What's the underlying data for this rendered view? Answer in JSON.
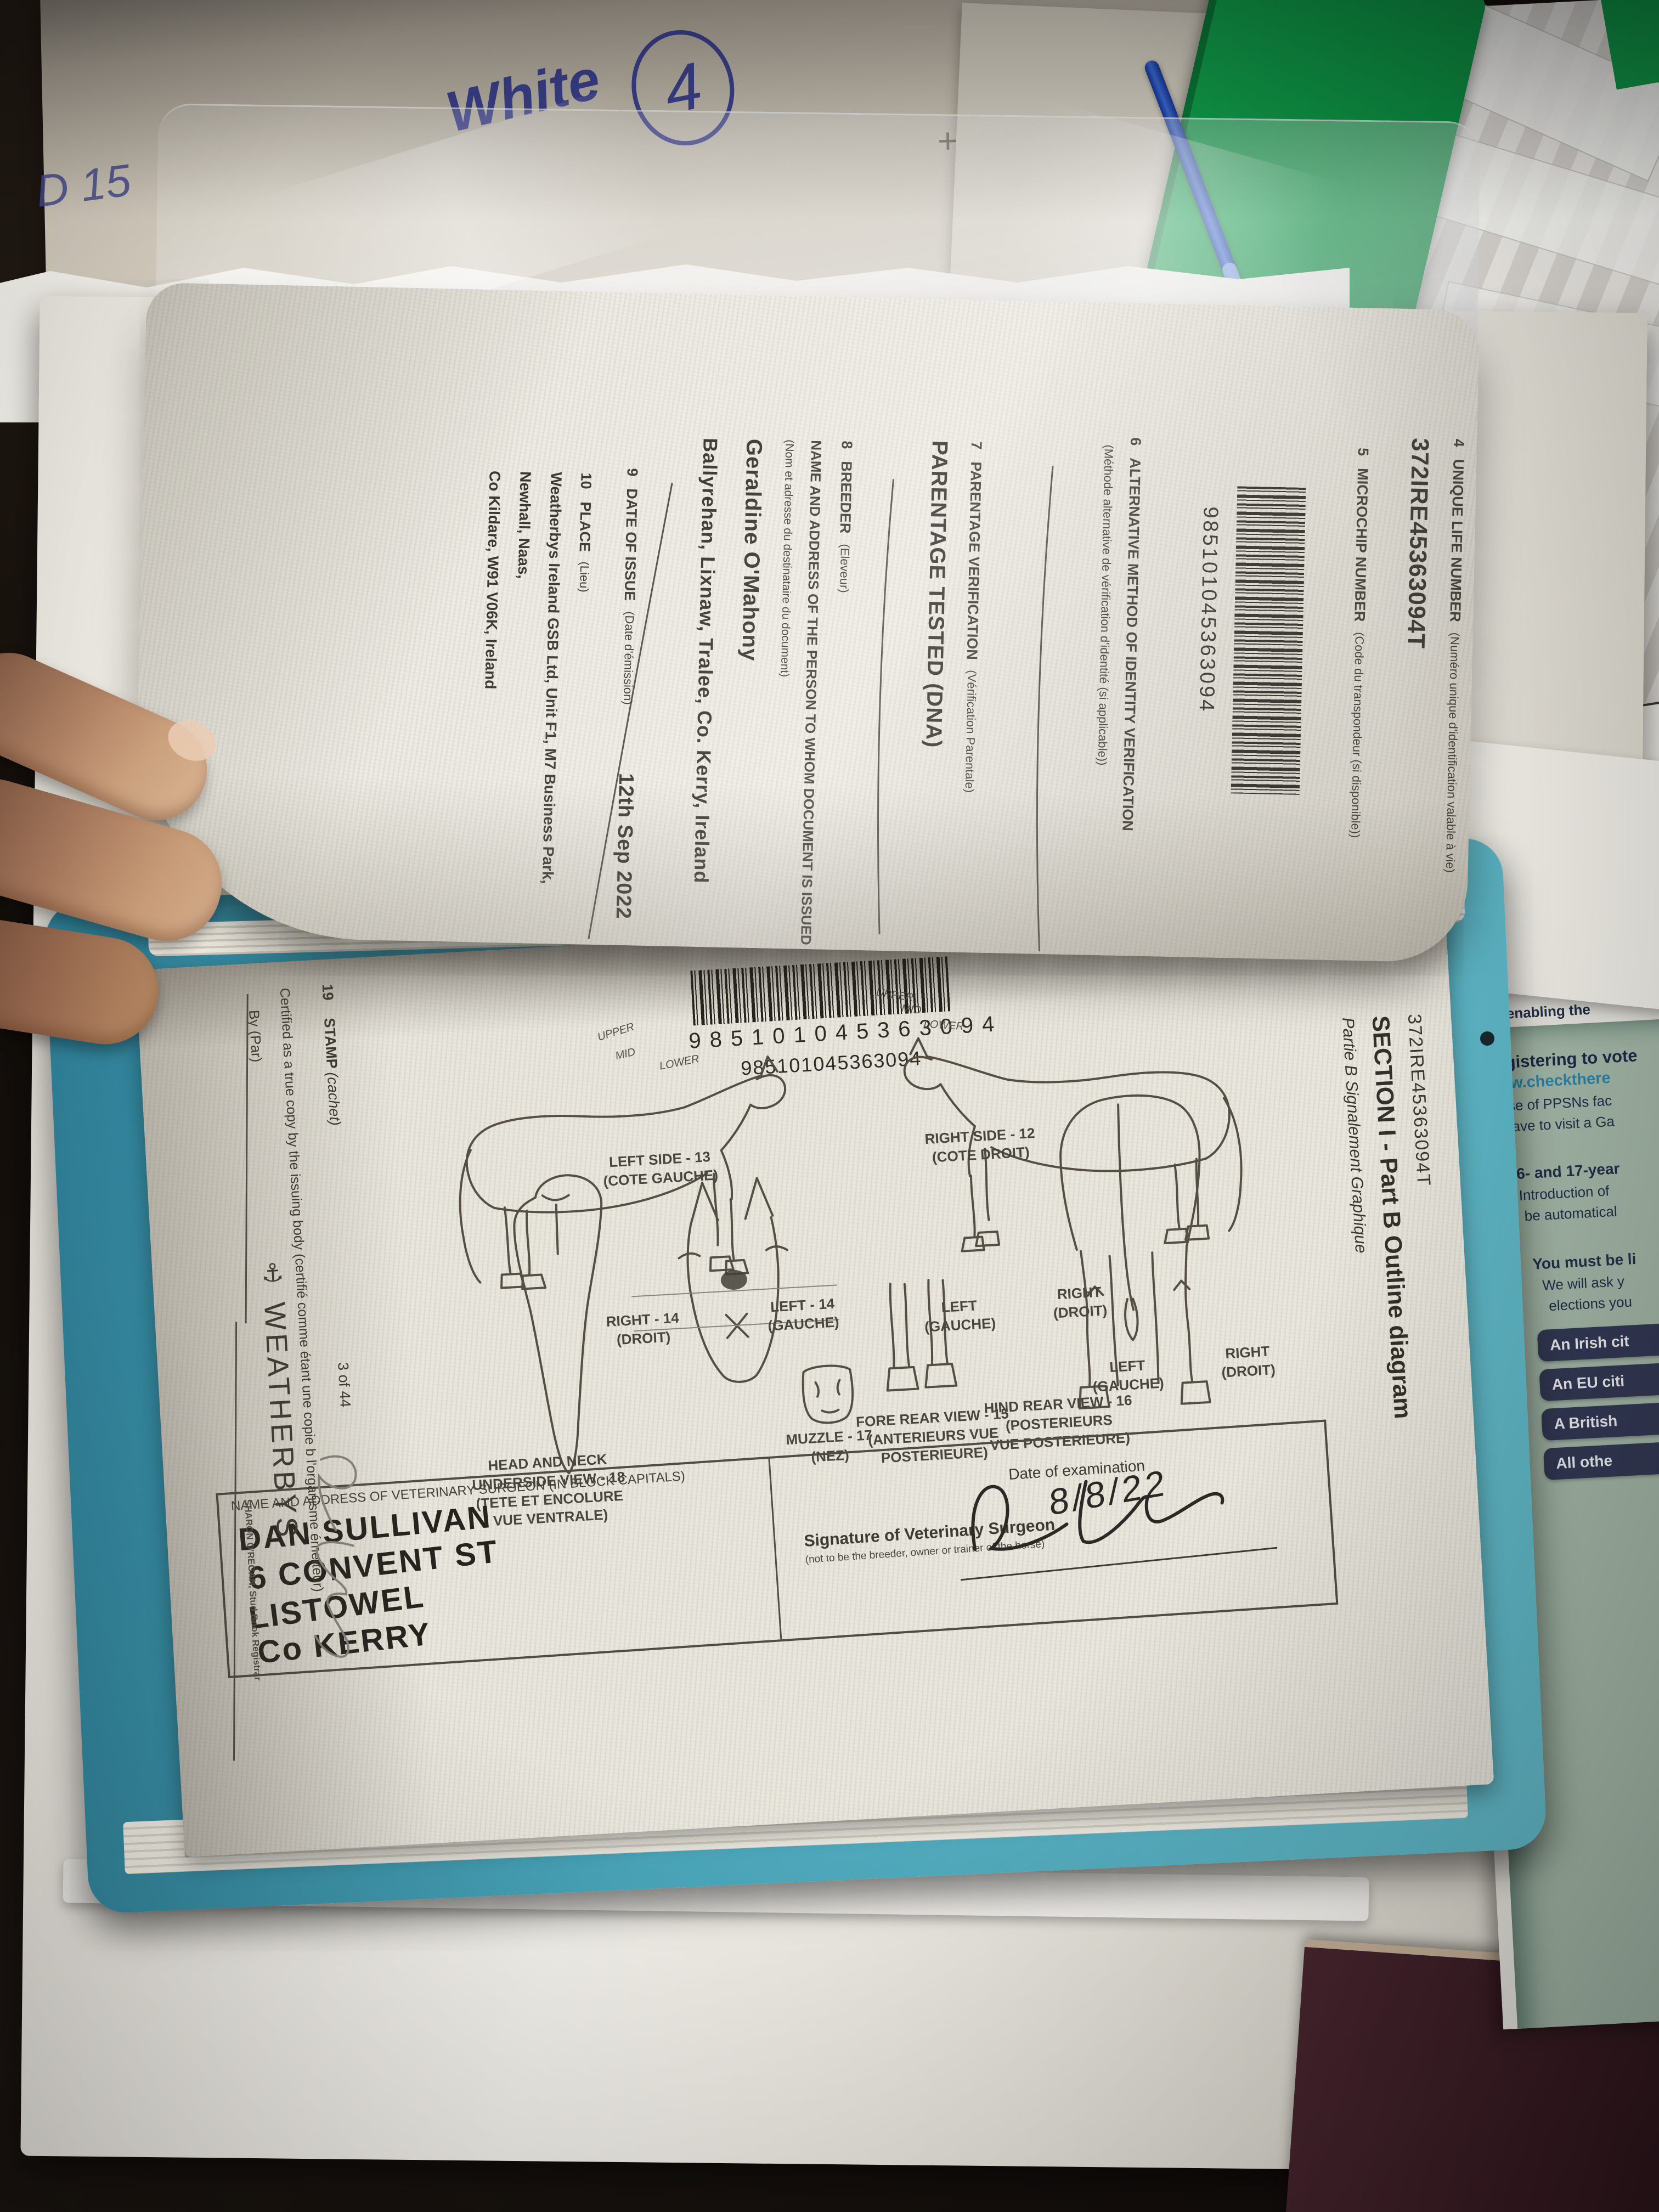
{
  "desk": {
    "note_word": "White",
    "note_circled": "4",
    "note_fragment": "D 15",
    "plus_mark": "+",
    "tab_top": "5",
    "tab_bottom": "LG"
  },
  "passport": {
    "flip_page": {
      "items": [
        {
          "num": "4",
          "heading": "UNIQUE LIFE NUMBER",
          "sub": "(Numéro unique d'identification valable à vie)",
          "value": "372IRE45363094T"
        },
        {
          "num": "5",
          "heading": "MICROCHIP NUMBER",
          "sub": "(Code du transpondeur (si disponible))",
          "value": "985101045363094"
        },
        {
          "num": "6",
          "heading": "ALTERNATIVE METHOD OF IDENTITY VERIFICATION",
          "sub": "(Méthode alternative de vérification d'identité (si applicable))"
        },
        {
          "num": "7",
          "heading": "PARENTAGE VERIFICATION",
          "sub": "(Vérification Parentale)",
          "value": "PARENTAGE TESTED (DNA)"
        },
        {
          "num": "8",
          "heading": "BREEDER",
          "sub": "(Eleveur)",
          "heading2": "NAME AND ADDRESS OF THE PERSON TO WHOM DOCUMENT IS ISSUED",
          "sub2": "(Nom et adresse du destinataire du document)",
          "value": "Geraldine O'Mahony",
          "value2": "Ballyrehan, Lixnaw, Tralee, Co. Kerry, Ireland"
        },
        {
          "num": "9",
          "heading": "DATE OF ISSUE",
          "sub": "(Date d'émission)",
          "value": "12th Sep 2022"
        },
        {
          "num": "10",
          "heading": "PLACE",
          "sub": "(Lieu)",
          "value": "Weatherbys Ireland GSB Ltd, Unit F1, M7 Business Park, Newhall, Naas,",
          "value2": "Co Kildare, W91 V06K, Ireland"
        }
      ]
    },
    "diagram_page": {
      "life_number": "372IRE45363094T",
      "title": "SECTION I - Part B Outline diagram",
      "subtitle": "Partie B Signalement Graphique",
      "barcode_value": "985101045363094",
      "labels": {
        "left_side": "LEFT SIDE - 13",
        "left_side_fr": "(COTE GAUCHE)",
        "right_side": "RIGHT SIDE - 12",
        "right_side_fr": "(COTE DROIT)",
        "head_right": "RIGHT - 14",
        "head_right_fr": "(DROIT)",
        "head_left": "LEFT - 14",
        "head_left_fr": "(GAUCHE)",
        "muzzle": "MUZZLE - 17",
        "muzzle_fr": "(NEZ)",
        "fore_rear": "FORE REAR VIEW - 15",
        "fore_rear_fr": "(ANTERIEURS VUE POSTERIEURE)",
        "hind_rear": "HIND REAR VIEW - 16 (POSTERIEURS",
        "hind_rear_fr": "VUE POSTERIEURE)",
        "rear_left": "LEFT",
        "rear_left_fr": "(GAUCHE)",
        "rear_right": "RIGHT",
        "rear_right_fr": "(DROIT)",
        "underside": "HEAD AND NECK UNDERSIDE VIEW - 18",
        "underside_fr": "(TETE ET ENCOLURE VUE VENTRALE)",
        "zone_upper": "UPPER",
        "zone_mid": "MID",
        "zone_lower": "LOWER"
      },
      "vet_box": {
        "label": "NAME AND ADDRESS OF VETERINARY SURGEON (IN BLOCK CAPITALS)",
        "handwritten": [
          "DAN SULLIVAN",
          "6 CONVENT ST",
          "LISTOWEL",
          "Co KERRY"
        ],
        "signature_label": "Signature of Veterinary Surgeon",
        "signature_note": "(not to be the breeder, owner or trainer of the horse)",
        "date_label": "Date of examination",
        "date_value": "8/8/22"
      },
      "footer": {
        "stamp_num": "19",
        "stamp_label": "STAMP ",
        "stamp_label_fr": "(cachet)",
        "certified": "Certified as a true copy by the issuing body (certifié comme étant une copie b l'organisme émetteur)",
        "by_label": "By (Par)",
        "brand": "WEATHERBYS",
        "anchor_icon": "⚓",
        "registrar": "SHARON O'REGAN, Stud Book Registrar",
        "page_number": "3 of 44"
      }
    }
  },
  "leaflet": {
    "frag1": "registe",
    "frag2": "well as enabling the",
    "bullet_glyph": "•",
    "heading": "Registering to vote",
    "link": "www.checkthere",
    "line1": "Use of PPSNs fac",
    "line2": "have to visit a Ga",
    "b1_head": "16- and 17-year",
    "b1_l1": "Introduction of",
    "b1_l2": "be automatical",
    "b2_head": "You must be li",
    "b2_l1": "We will ask y",
    "b2_l2": "elections you",
    "buttons": [
      "An Irish cit",
      "An EU citi",
      "A British",
      "All othe"
    ]
  },
  "colors": {
    "cover_teal": "#4aa6ba",
    "leaflet_bg": "#a7bbab",
    "leaflet_button": "#343a56",
    "leaflet_link": "#2d86ad",
    "folder_green": "#10a04b",
    "pen_blue": "#2f5fc9",
    "ink_blue": "#3e4494",
    "book_maroon": "#42222b"
  }
}
